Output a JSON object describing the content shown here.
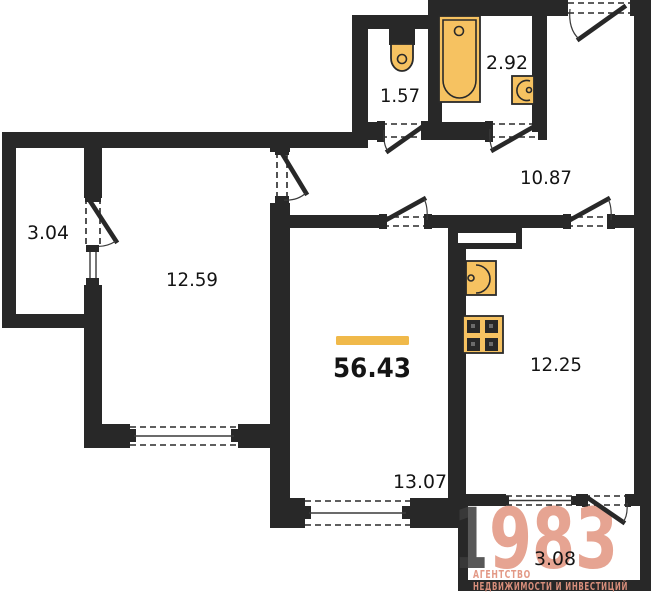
{
  "colors": {
    "wall": "#282828",
    "fixture_fill": "#f6c261",
    "fixture_stroke": "#2a2a2a",
    "accent_bar": "#f0b94a",
    "label_text": "#141414",
    "logo_dark": "#3b3b3b",
    "logo_accent": "#e2947f"
  },
  "rooms": {
    "balcony_left": {
      "area": "3.04"
    },
    "bedroom": {
      "area": "12.59"
    },
    "wc": {
      "area": "1.57"
    },
    "bathroom": {
      "area": "2.92"
    },
    "hallway": {
      "area": "10.87"
    },
    "kitchen": {
      "area": "12.25"
    },
    "living_room": {
      "area": "13.07"
    },
    "balcony_bottom": {
      "area": "3.08"
    }
  },
  "total": {
    "area": "56.43"
  },
  "logo": {
    "digit_first": "1",
    "digits_rest": "983",
    "tagline_line1": "АГЕНТСТВО",
    "tagline_line2": "НЕДВИЖИМОСТИ И ИНВЕСТИЦИЙ"
  },
  "fixtures": {
    "toilet": "toilet-icon",
    "bathtub": "bathtub-icon",
    "bath_sink": "sink-icon",
    "kitchen_sink": "sink-icon",
    "stove": "stove-icon",
    "vent_duct": "vent-duct-icon"
  }
}
